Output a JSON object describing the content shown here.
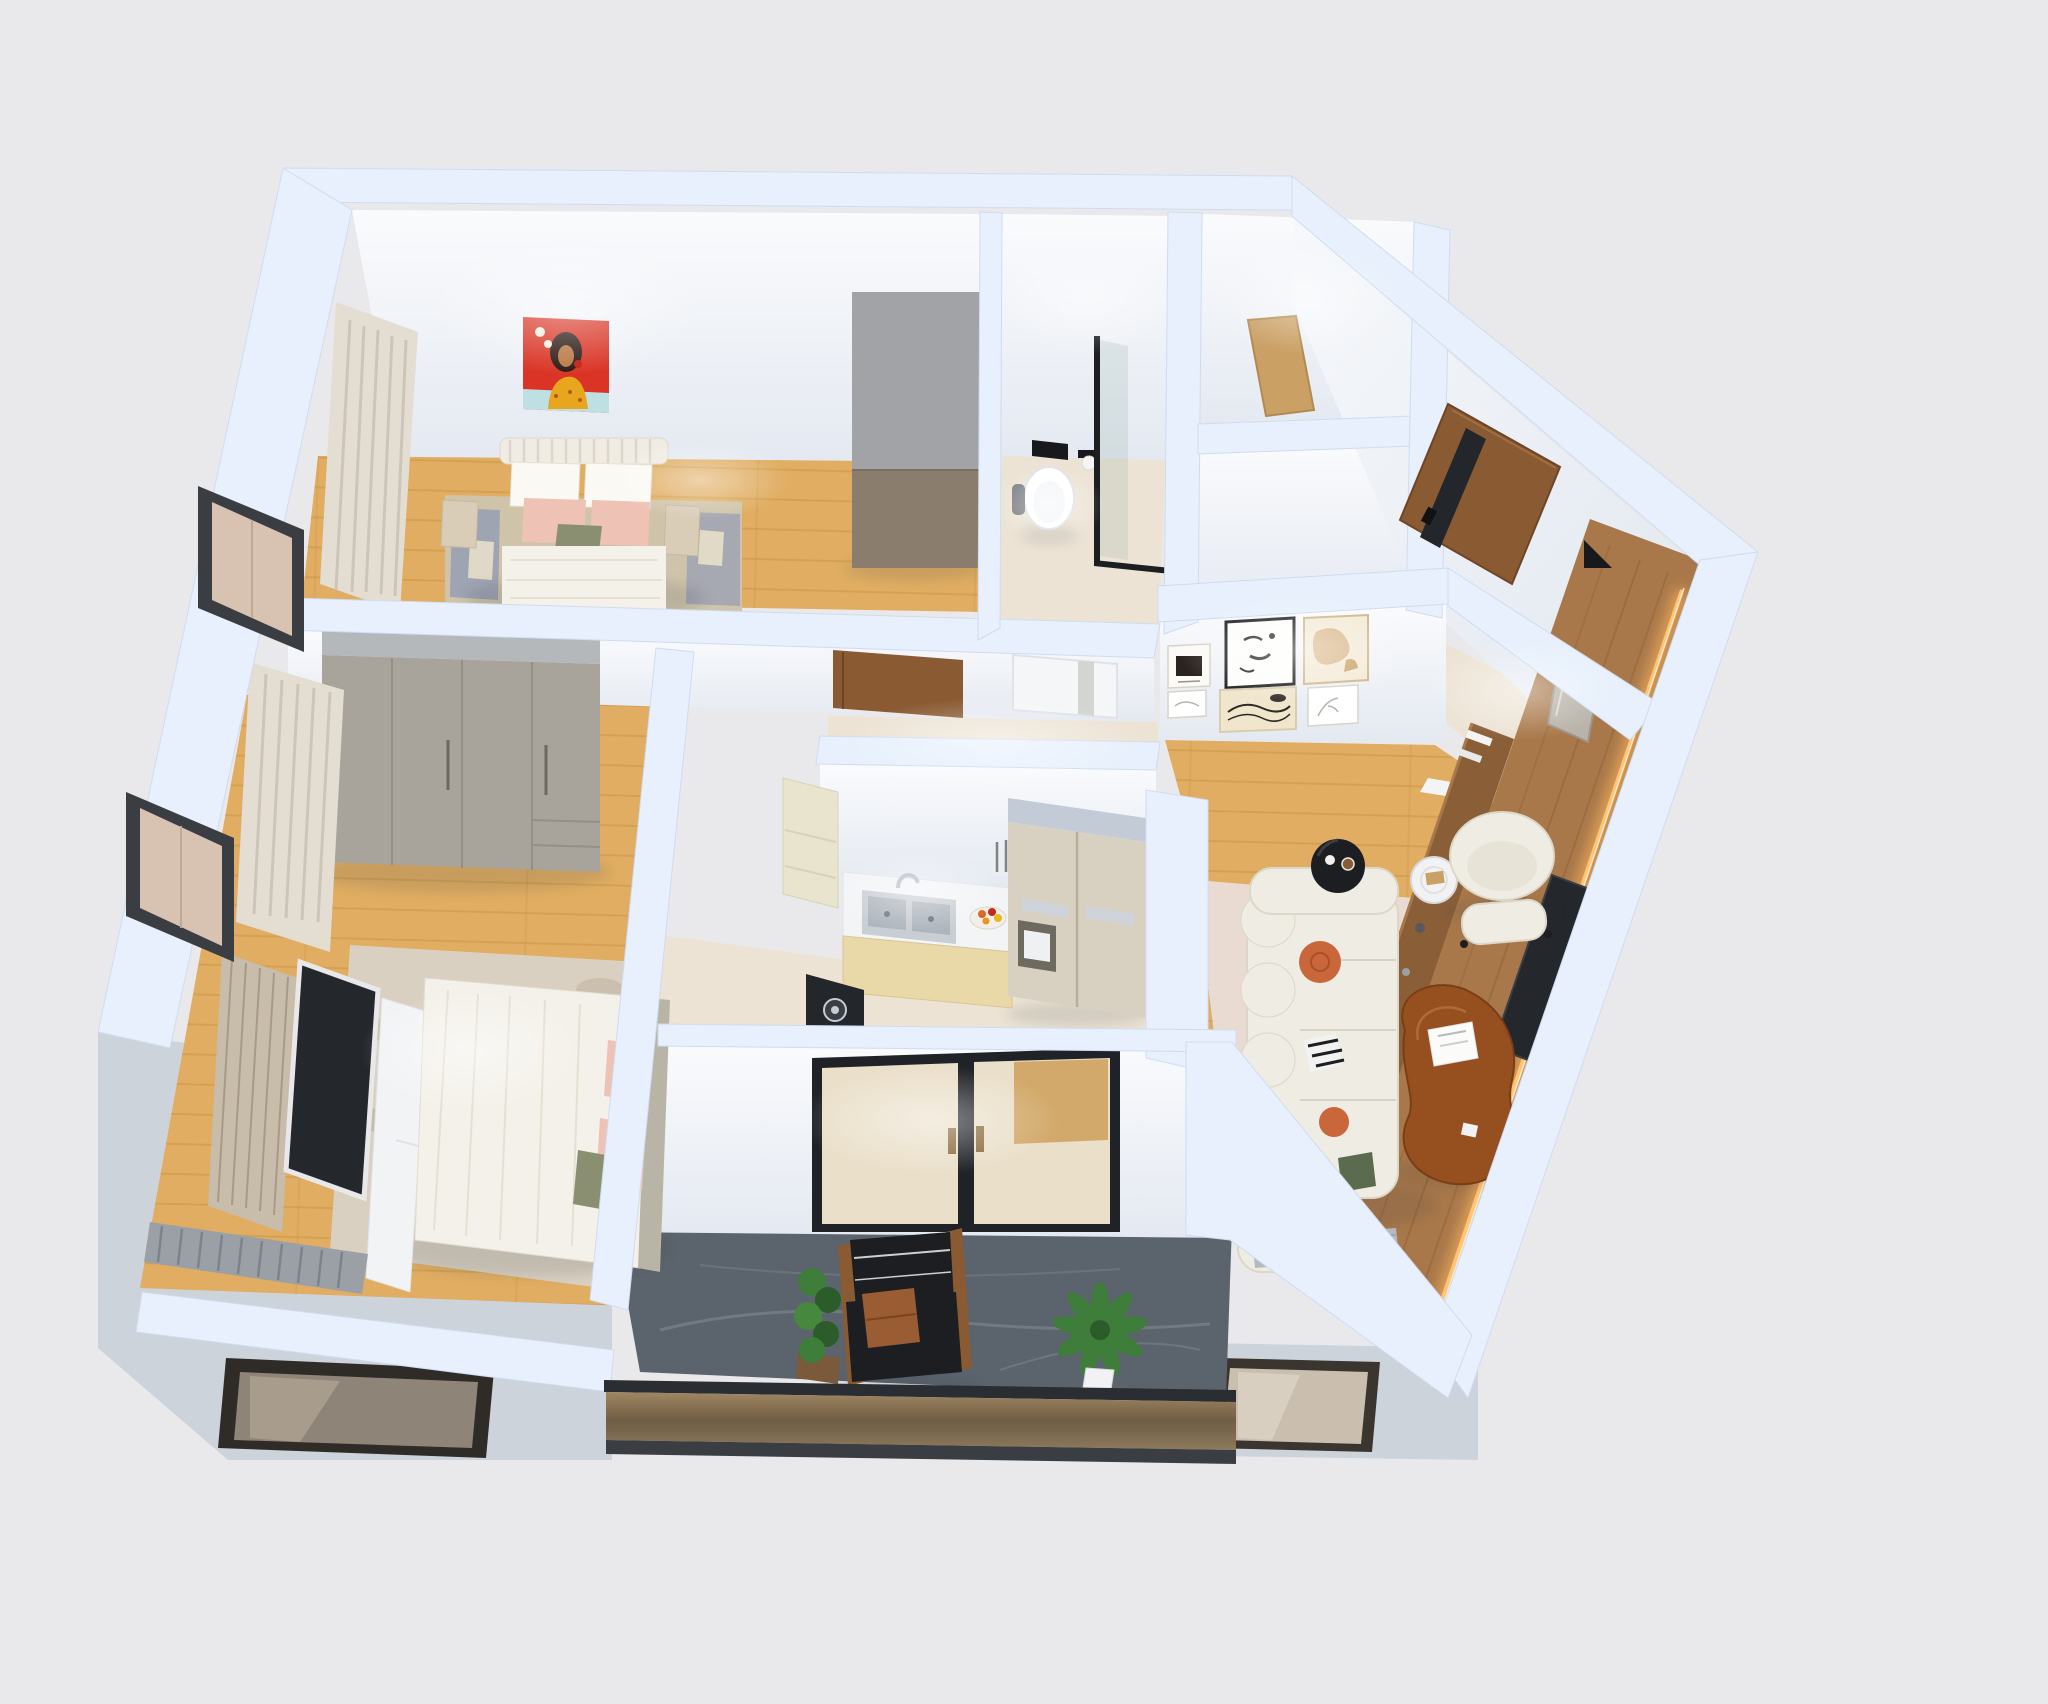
{
  "scene": {
    "title": "3D isometric apartment floor plan render",
    "view": "top-down axonometric",
    "rooms_count": 8
  },
  "palette": {
    "background": "#e9e9eb",
    "wall_top": "#e7f0fc",
    "wall_face_light": "#f8fafc",
    "wall_face_shade": "#e3e8f0",
    "facade_gray": "#ccd3da",
    "wood_floor": "#e0ad62",
    "beige_floor": "#ece3d4",
    "balcony_floor": "#5b636c",
    "glass_tan": "#d8c3b2",
    "window_frame": "#3a3d42",
    "walnut_door": "#8a5a33",
    "panel_wood": "#a9784a",
    "oak_counter": "#caa064",
    "wardrobe_top": "#b5b8ba",
    "wardrobe_front": "#a8a39b",
    "cabinet_cream": "#e9e4cd",
    "counter_white": "#f3f4f6",
    "steel": "#c7ccd3",
    "fridge_front": "#d8d1c2",
    "sofa_white": "#efece3",
    "bed_white": "#f4f1ea",
    "pillow_orange": "#c9663a",
    "pillow_pink": "#eec2b4",
    "pillow_green": "#8a8f72",
    "rug_pink": "#eadbd2",
    "rug_stone": "#d9d0c1",
    "rug_beige": "#cfc4a9",
    "rug_blue": "#8a97b8",
    "coffee_table_wood": "#96501f",
    "tv_black": "#24272b",
    "led_glow": "#ffc476",
    "art_red": "#d93425",
    "art_teal": "#bfe0e2",
    "art_tan": "#d9b98c",
    "curtain_beige": "#e4ddd2",
    "curtain_gray": "#9aa0a6",
    "plant_green": "#3e7d3a",
    "chair_black": "#1c1e22",
    "leather_brown": "#9a5c33",
    "mirror_gray": "#b9b3a9",
    "glass_door_cream": "#eadfc9",
    "bronze_rail": "#8a7457"
  },
  "rooms": [
    {
      "id": "bedroom-1",
      "items": [
        "double-bed",
        "ribbed-headboard",
        "white-pillows",
        "pink-pillows",
        "green-accent-pillow",
        "red-portrait-artwork",
        "tall-cabinet",
        "beige-curtain",
        "blue-beige-rug",
        "nightstands"
      ]
    },
    {
      "id": "bathroom",
      "items": [
        "wall-hung-toilet",
        "black-flush-plate",
        "toilet-paper-holder",
        "toilet-brush",
        "glass-shower-screen"
      ]
    },
    {
      "id": "storage-room",
      "items": [
        "wooden-counter"
      ]
    },
    {
      "id": "entry",
      "items": [
        "walnut-front-door",
        "smart-lock-stripe",
        "leaning-mirror",
        "marble-floor",
        "black-wedge"
      ]
    },
    {
      "id": "hallway",
      "items": [
        "walnut-bedroom-door",
        "white-bathroom-door",
        "gallery-wall-six-frames"
      ]
    },
    {
      "id": "kitchen",
      "items": [
        "upper-cabinet",
        "double-stainless-sink",
        "faucet",
        "fruit-bowl",
        "knife-rack",
        "black-cooktop",
        "lower-cabinets",
        "double-door-refrigerator"
      ]
    },
    {
      "id": "living-room",
      "items": [
        "modular-boucle-sofa",
        "orange-round-pillows",
        "checkered-pillow",
        "green-pillow",
        "gray-fringed-throw",
        "black-round-side-table",
        "white-pedestal-table",
        "boucle-armchair",
        "ottoman",
        "kidney-coffee-table",
        "magazine",
        "wood-tv-panel-wall",
        "led-strip",
        "media-console",
        "pink-area-rug"
      ]
    },
    {
      "id": "bedroom-2",
      "items": [
        "gray-wardrobe",
        "double-bed-white-duvet",
        "pink-pillows",
        "tv-on-slat-panel",
        "white-tv-console",
        "beige-curtain",
        "gray-pleated-curtain",
        "stone-pattern-rug"
      ]
    },
    {
      "id": "balcony",
      "items": [
        "black-lounge-chair",
        "leather-pillow",
        "planter-box",
        "potted-plant",
        "glass-double-door",
        "glass-balustrade",
        "dark-marble-floor"
      ]
    },
    {
      "id": "exterior",
      "items": [
        "bay-window-upper",
        "bay-window-lower",
        "facade-window-south-west",
        "facade-window-south-east"
      ]
    }
  ]
}
